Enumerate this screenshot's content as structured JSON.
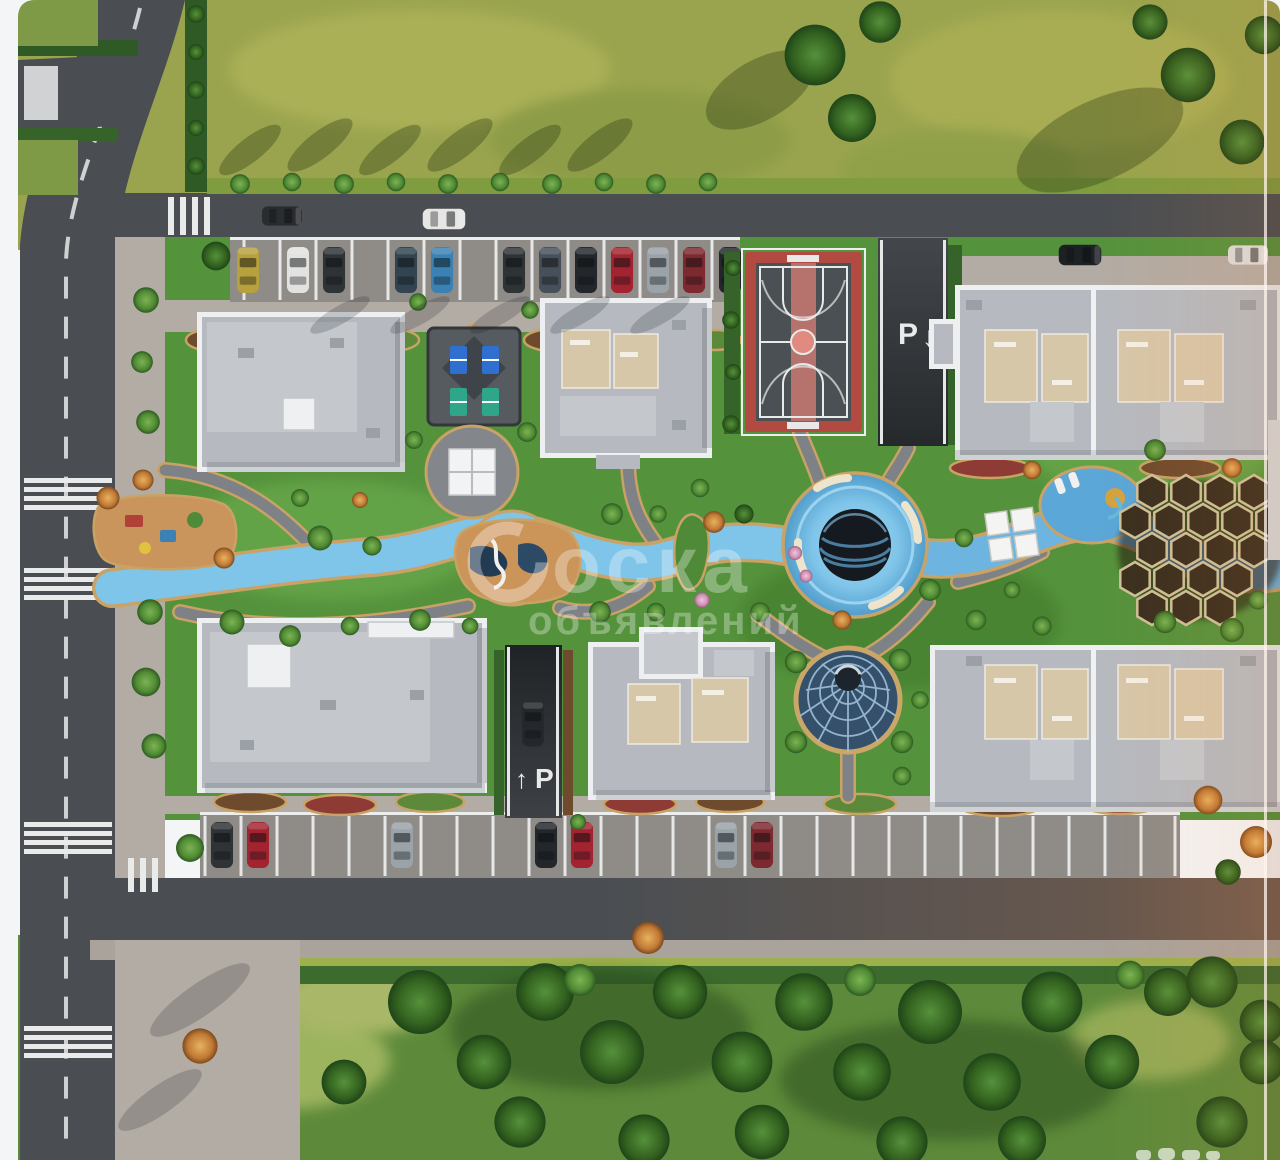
{
  "image": {
    "kind": "3D aerial master-plan rendering of a residential complex",
    "watermark": {
      "line1": "оска",
      "line2": "объявлений",
      "color": "#ffffff"
    },
    "road_markings": {
      "top_garage_ramp": {
        "letter": "P",
        "arrow": "↓"
      },
      "bottom_garage_ramp": {
        "letter": "P",
        "arrow": "↑"
      }
    },
    "features": [
      "six apartment buildings with rooftop terraces",
      "basketball court",
      "two underground parking ramps",
      "winding lazy-river water feature",
      "circular pool plaza with benches and dark sphere",
      "glass dome pavilion",
      "honeycomb canopy",
      "table-tennis court",
      "playgrounds",
      "street parking rows with cars",
      "zebra crosswalks",
      "forest belt and lawns"
    ],
    "palette": {
      "field_grass": "#9aa44e",
      "campus_lawn": "#55923c",
      "forest_green": "#5d8a3a",
      "road_asphalt": "#4a4e52",
      "parking_asphalt": "#8f8b87",
      "sidewalk": "#b3aca4",
      "roof_gray": "#b6bac0",
      "parapet_white": "#edeff1",
      "terrace_beige": "#d7c7a9",
      "water_blue": "#7fc4e9",
      "path_edge_gold": "#c9a265",
      "court_red": "#b34a41",
      "dome_glass": "#35506b",
      "honeycomb_brown": "#3a2f1f"
    }
  }
}
